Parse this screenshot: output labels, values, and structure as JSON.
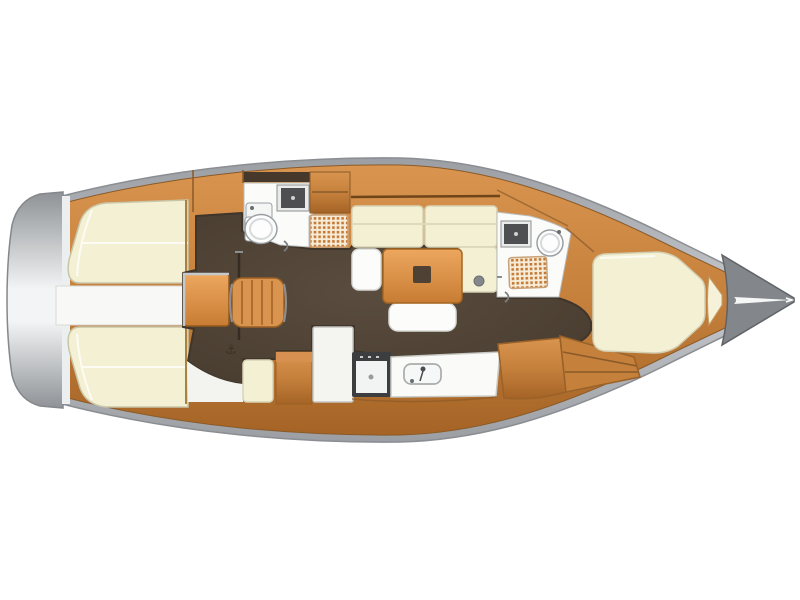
{
  "title": "Sailboat interior floor plan (top-down deck layout)",
  "diagram_type": "yacht-floorplan",
  "orientation": {
    "bow": "right",
    "stern": "left"
  },
  "icons": {
    "anchor_glyph": "⚓"
  },
  "colors": {
    "background": "#ffffff",
    "hull_light": "#c6c9cd",
    "hull_mid": "#9b9ea3",
    "hull_dark": "#6f7276",
    "transom_light": "#f2f4f5",
    "transom_dark": "#8f9296",
    "wood_light": "#d9954f",
    "wood_mid": "#c5803c",
    "wood_dark": "#a56426",
    "wood_seam": "#7c4e1e",
    "floor_mid": "#5a4d3f",
    "floor_dark": "#463a2e",
    "hatch_dark": "#46382a",
    "cushion_cream": "#f4f0d4",
    "cushion_border": "#d6d2b4",
    "fixture_white": "#fbfbf9",
    "fixture_outline": "#9aa0a2",
    "panel_white": "#f4f4f1",
    "sink_dark": "#4d4f50",
    "stove_frame": "#3c3d3e",
    "grate_bg": "#f7ecd8",
    "grate_dot": "#c47a36",
    "table_light": "#eda75f",
    "table_dark": "#c87c33",
    "table_inlay": "#4f4234",
    "metal_gray": "#85888b",
    "glyph_dark": "#3a3128"
  },
  "regions": [
    {
      "id": "aft-cabin-port",
      "label": "aft double berth (port)"
    },
    {
      "id": "aft-cabin-starboard",
      "label": "aft double berth (starboard)"
    },
    {
      "id": "engine-walkway",
      "label": "companionway / engine access"
    },
    {
      "id": "nav-station",
      "label": "chart table and seat"
    },
    {
      "id": "aft-head",
      "label": "aft head with toilet, sink and shower grate"
    },
    {
      "id": "salon",
      "label": "salon with U-settee, table and benches"
    },
    {
      "id": "galley",
      "label": "galley with stove, sink counter and fridge"
    },
    {
      "id": "fwd-head",
      "label": "forward head with basin and shower grate"
    },
    {
      "id": "v-berth",
      "label": "forward V-berth cabin"
    },
    {
      "id": "bow",
      "label": "bow with anchor locker"
    }
  ]
}
